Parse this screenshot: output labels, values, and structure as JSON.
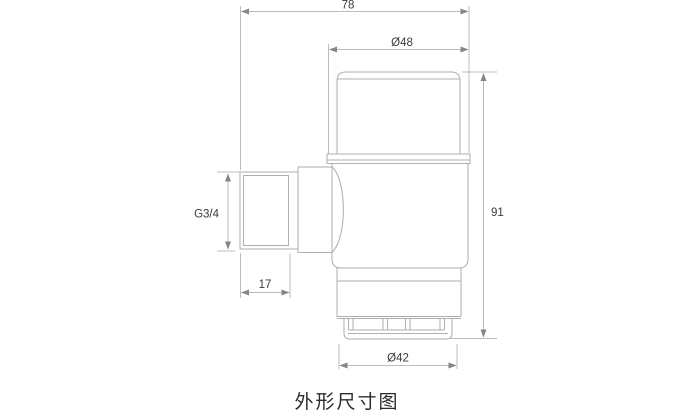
{
  "page": {
    "caption": "外形尺寸图"
  },
  "colors": {
    "outline": "#aeaeb3",
    "dimension_line": "#bcbcc0",
    "arrow": "#86868a",
    "text": "#3a3a3a",
    "caption_text": "#2c2c2c",
    "background": "#ffffff"
  },
  "dimensions": {
    "total_width": {
      "label": "78"
    },
    "cap_diameter": {
      "label": "Ø48"
    },
    "total_height": {
      "label": "91"
    },
    "inlet_thread": {
      "label": "G3/4"
    },
    "thread_length": {
      "label": "17"
    },
    "outlet_diameter": {
      "label": "Ø42"
    }
  }
}
